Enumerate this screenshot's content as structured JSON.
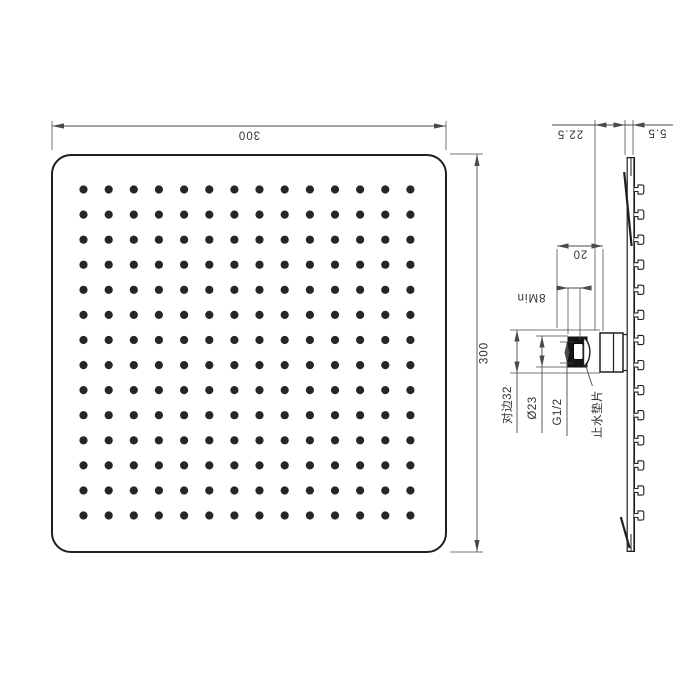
{
  "drawing_title": "square shower head dimensional drawing",
  "front_view": {
    "top_dim": "300",
    "right_dim": "300",
    "nozzle_rows": 14,
    "nozzle_cols": 14
  },
  "side_view": {
    "nozzle_count": 14,
    "dims": {
      "depth": "22.5",
      "thickness": "5.5",
      "boss": "20",
      "thread_min": "8Min",
      "hex_flats": "对边32",
      "gasket_od": "Ø23",
      "thread": "G1/2"
    },
    "gasket_label": "止水垫片"
  },
  "colors": {
    "line": "#1f1f1f",
    "dim": "#4a4a4a",
    "text": "#333333",
    "dot": "#262626",
    "gasket_fill": "#151515",
    "background": "#ffffff"
  }
}
